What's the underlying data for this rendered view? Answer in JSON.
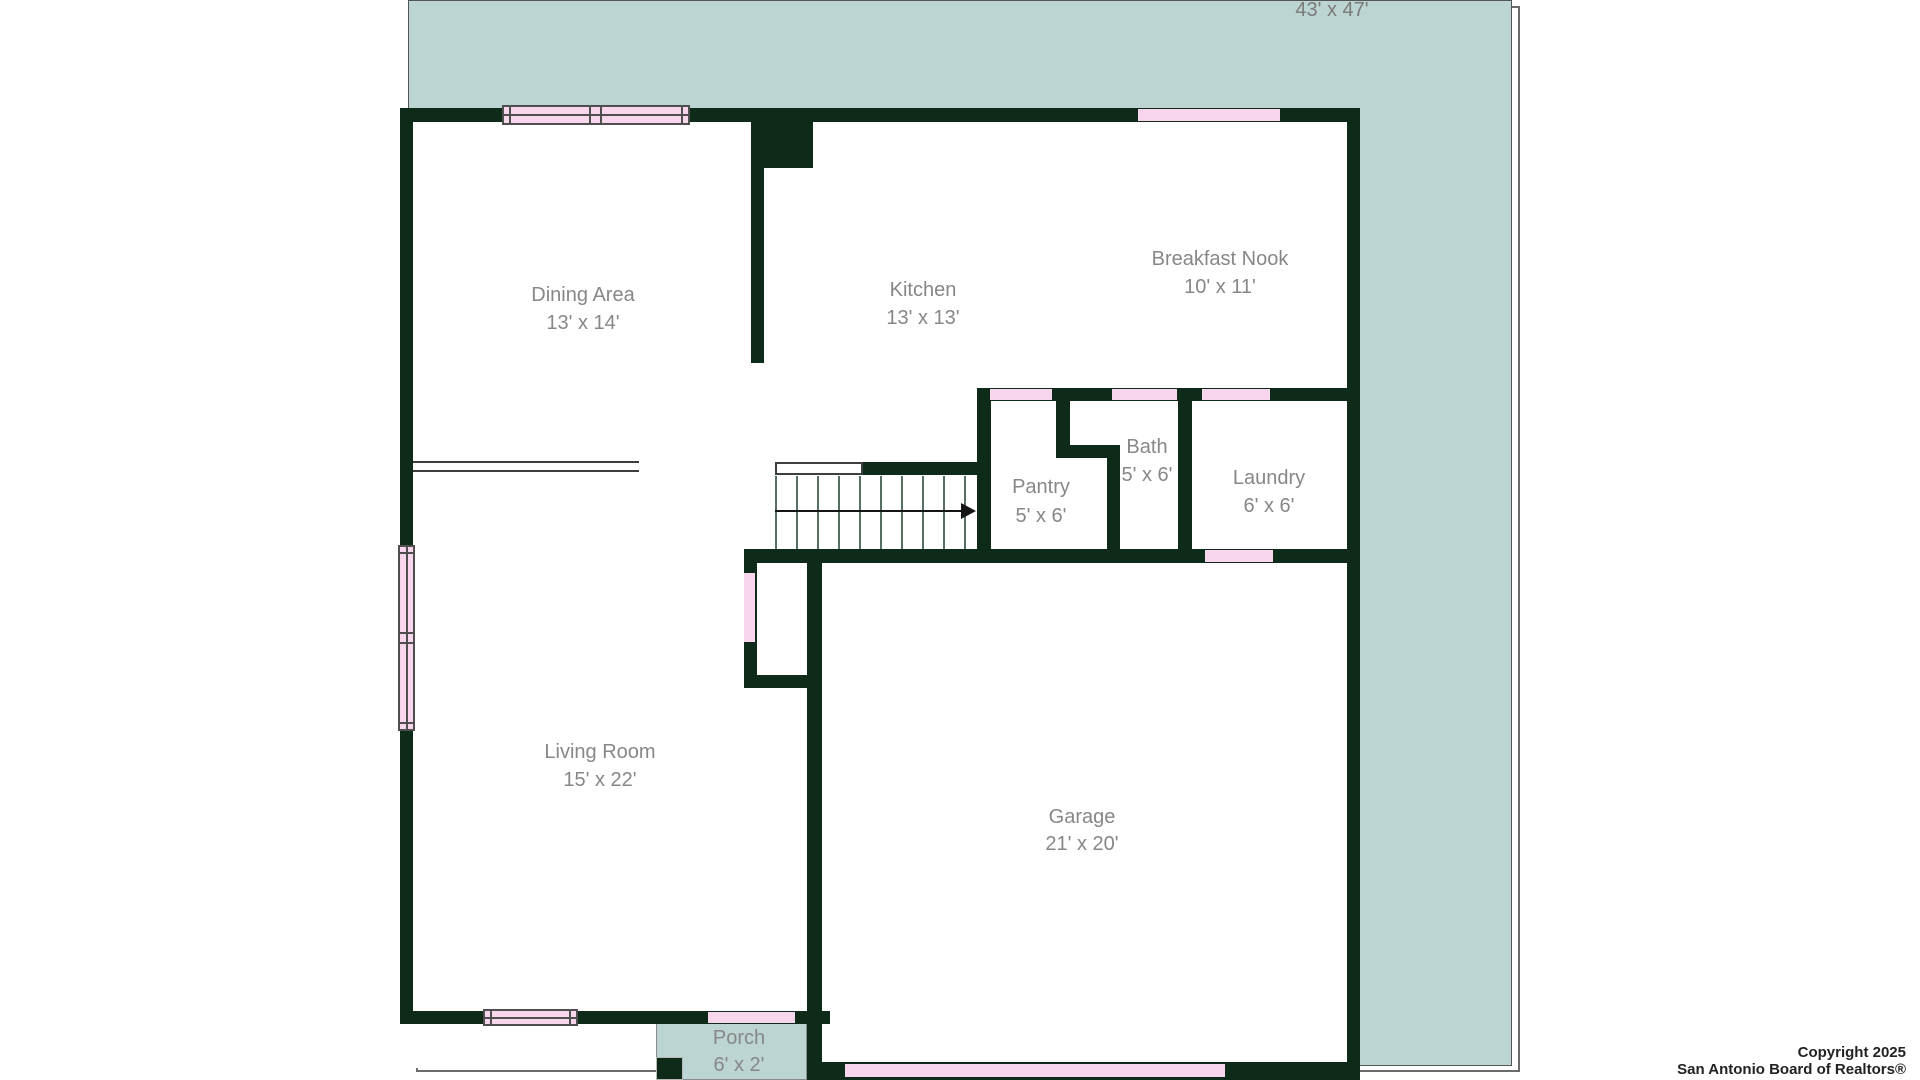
{
  "lot": {
    "dimensions_label": "43' x 47'"
  },
  "rooms": [
    {
      "name": "Dining Area",
      "dimensions": "13' x 14'"
    },
    {
      "name": "Kitchen",
      "dimensions": "13' x 13'"
    },
    {
      "name": "Breakfast Nook",
      "dimensions": "10' x 11'"
    },
    {
      "name": "Pantry",
      "dimensions": "5' x 6'"
    },
    {
      "name": "Bath",
      "dimensions": "5' x 6'"
    },
    {
      "name": "Laundry",
      "dimensions": "6' x 6'"
    },
    {
      "name": "Living Room",
      "dimensions": "15' x 22'"
    },
    {
      "name": "Garage",
      "dimensions": "21' x 20'"
    },
    {
      "name": "Porch",
      "dimensions": "6' x 2'"
    }
  ],
  "footer": {
    "copyright_line1": "Copyright 2025",
    "copyright_line2": "San Antonio Board of Realtors®"
  },
  "colors": {
    "wall": "#0e2b19",
    "lot": "#bcd5d3",
    "opening": "#f8d6ee",
    "label": "#878787"
  }
}
